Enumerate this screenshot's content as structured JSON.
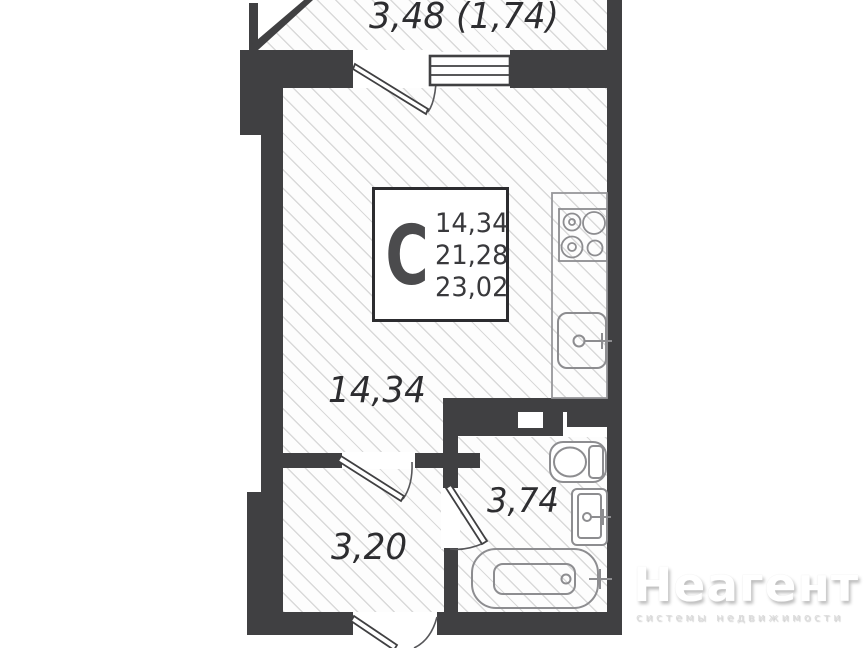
{
  "plan": {
    "balcony_label": "3,48 (1,74)",
    "room_label": "14,34",
    "hallway_label": "3,20",
    "bathroom_label": "3,74",
    "info_box": {
      "letter": "С",
      "area_living": "14,34",
      "area_usable": "21,28",
      "area_total": "23,02"
    },
    "colors": {
      "wall": "#404042",
      "fixture_outline": "#8d8d90",
      "hatch": "#d9d9d9",
      "label_text": "#2d2d30"
    }
  },
  "watermark": {
    "brand": "Неагент",
    "tagline": "системы недвижимости"
  }
}
